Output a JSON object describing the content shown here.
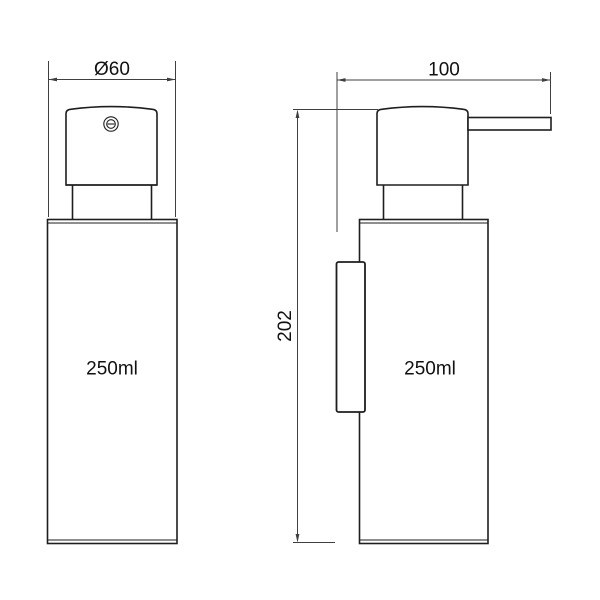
{
  "colors": {
    "bg": "#ffffff",
    "object-line": "#1e1e1e",
    "dim-line": "#3f3f3f",
    "text-color": "#111111"
  },
  "drawing": {
    "kind": "technical dimension drawing, wall-mounted soap dispenser",
    "front_view": {
      "capacity_label": "250ml",
      "diameter_dimension": "Ø60"
    },
    "side_view": {
      "capacity_label": "250ml",
      "depth_dimension": "100",
      "height_dimension": "202"
    },
    "icons": {
      "pump_outlet": "concentric circles with horizontal dash"
    }
  }
}
